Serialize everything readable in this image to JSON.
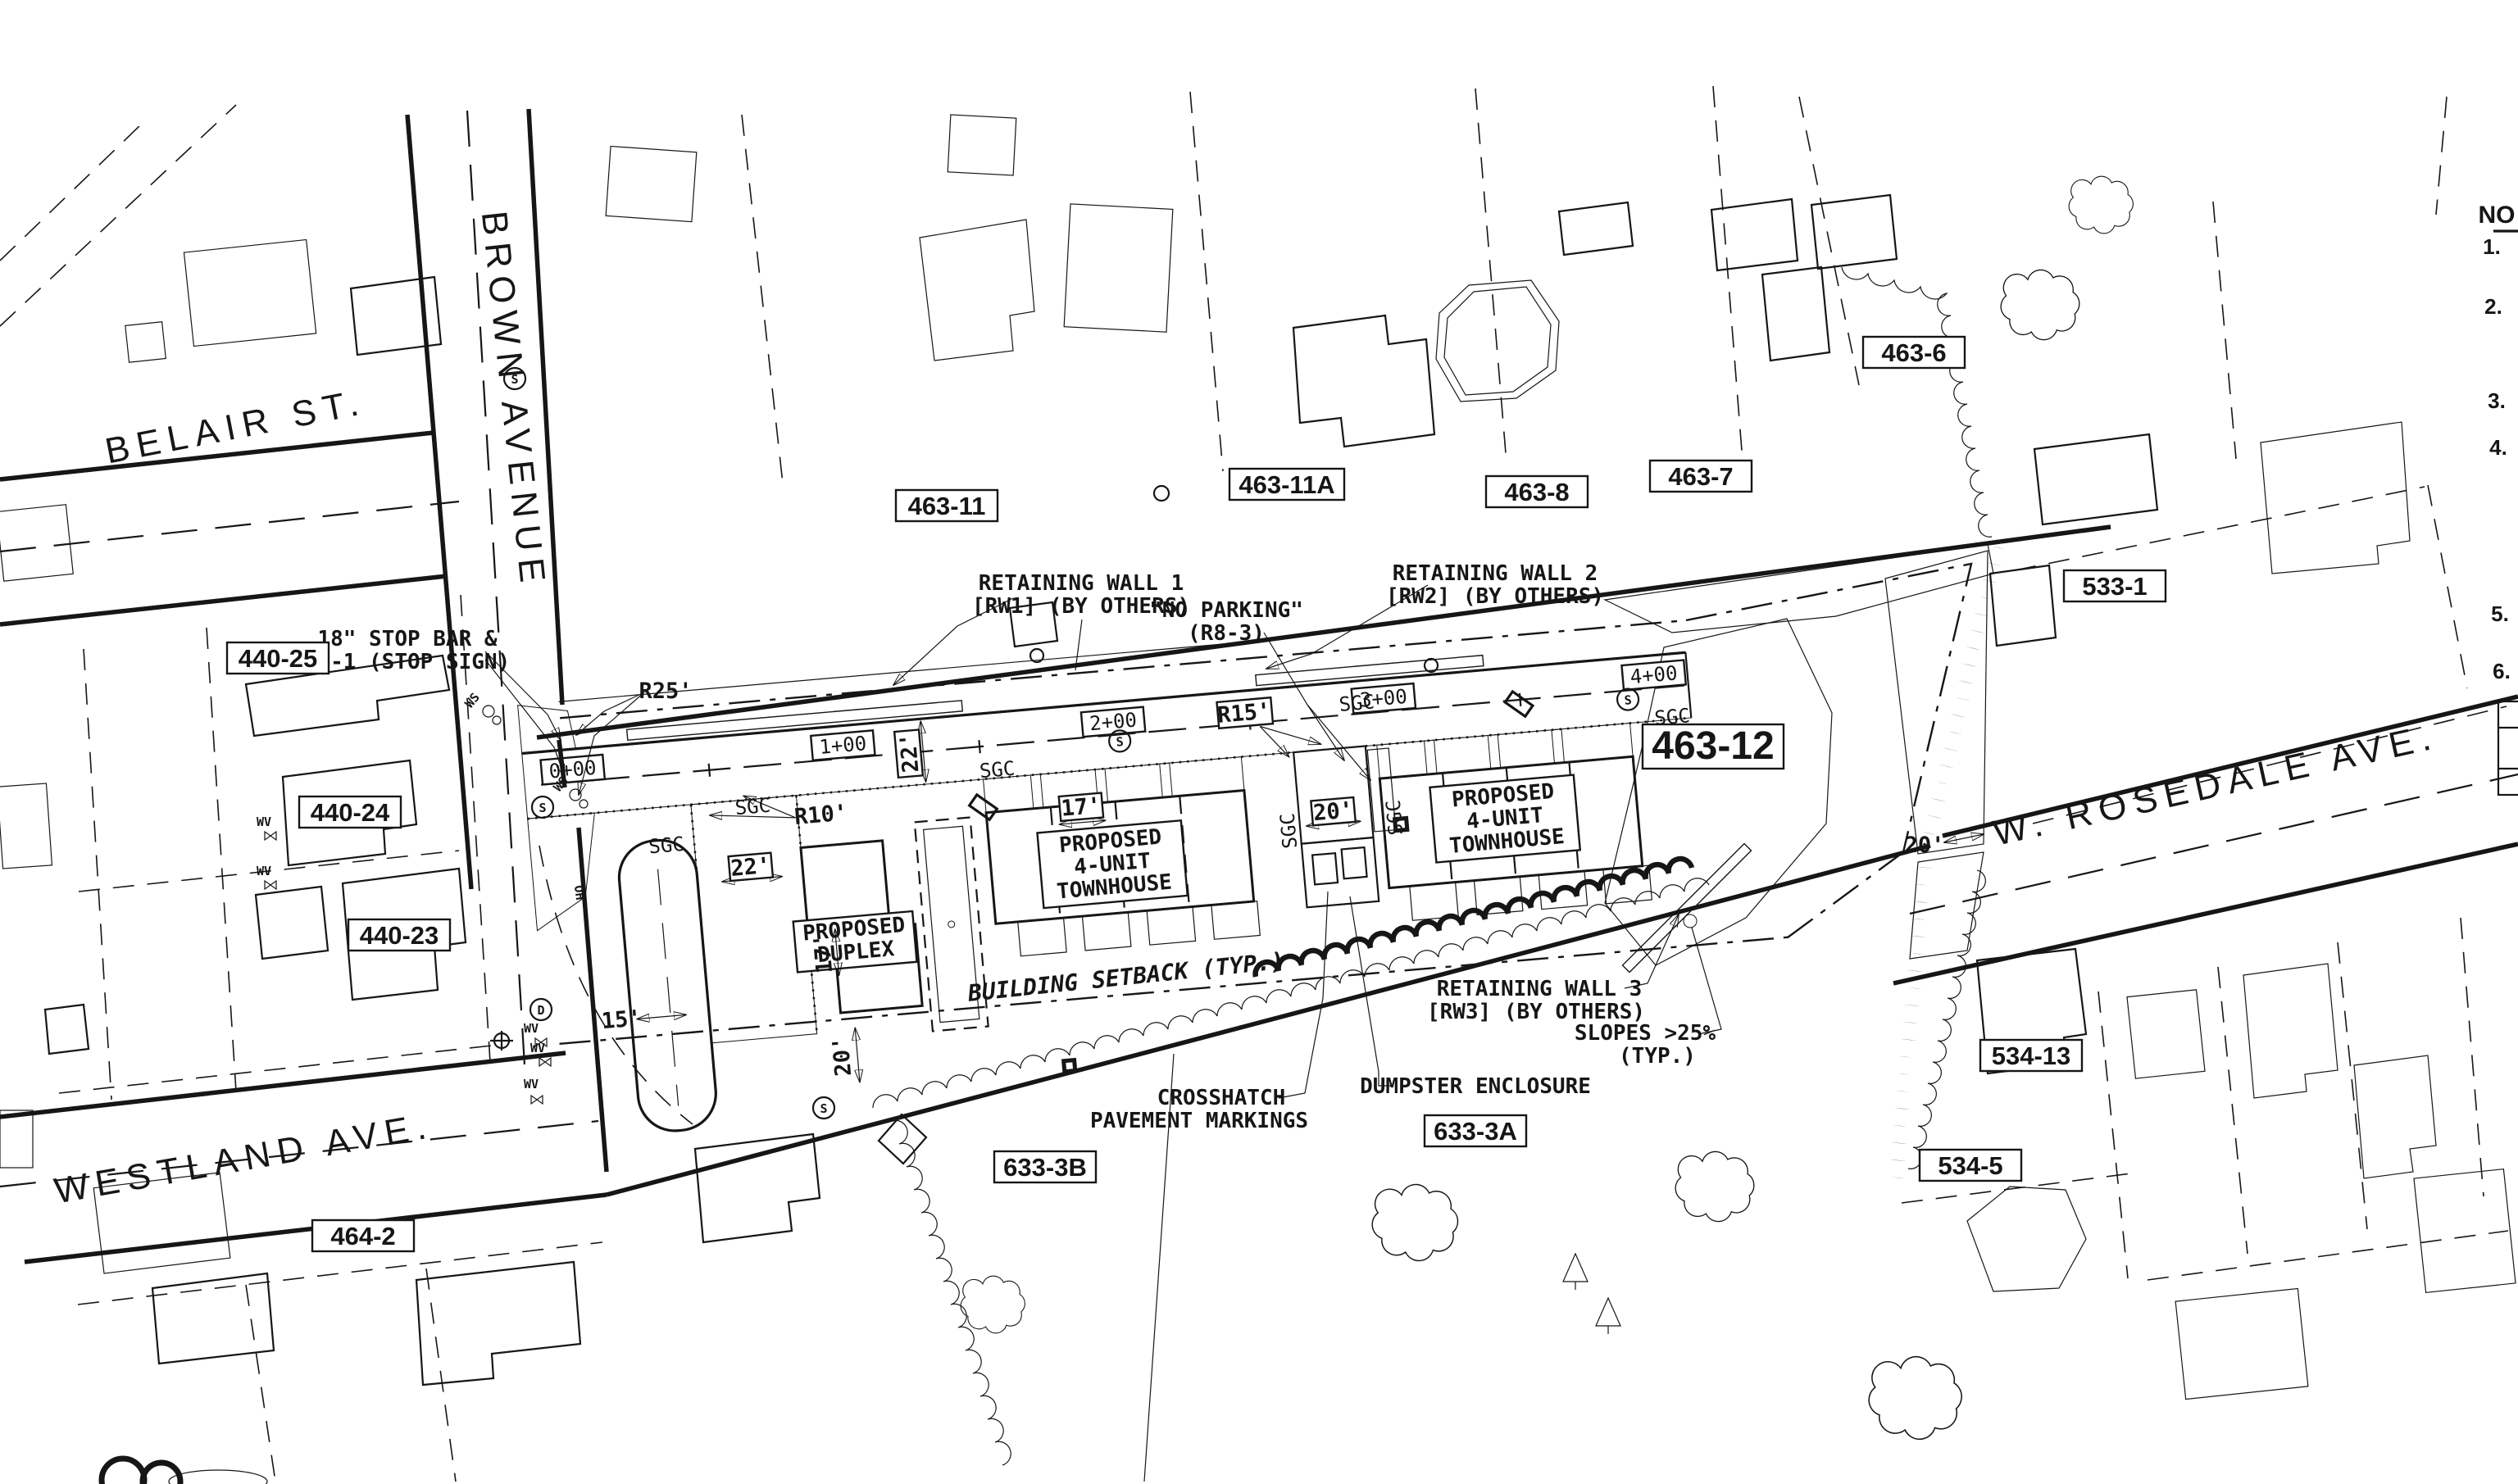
{
  "plan": {
    "streets": {
      "belair": "BELAIR ST.",
      "brown": "BROWN AVENUE",
      "westland": "WESTLAND AVE.",
      "rosedale": "W. ROSEDALE AVE."
    },
    "parcels": {
      "p440_25": "440-25",
      "p440_24": "440-24",
      "p440_23": "440-23",
      "p464_2": "464-2",
      "p463_11": "463-11",
      "p463_11a": "463-11A",
      "p463_8": "463-8",
      "p463_7": "463-7",
      "p463_6": "463-6",
      "p533_1": "533-1",
      "p463_12": "463-12",
      "p534_13": "534-13",
      "p534_5": "534-5",
      "p633_3b": "633-3B",
      "p633_3a": "633-3A"
    },
    "stations": [
      "0+00",
      "1+00",
      "2+00",
      "3+00",
      "4+00"
    ],
    "proposed": {
      "duplex_l1": "PROPOSED",
      "duplex_l2": "DUPLEX",
      "th_l1": "PROPOSED",
      "th_l2": "4-UNIT",
      "th_l3": "TOWNHOUSE"
    },
    "annotations": {
      "stop_bar_l1": "18\" STOP BAR &",
      "stop_bar_l2": "R1-1 (STOP SIGN)",
      "rw1_l1": "RETAINING WALL 1",
      "rw1_l2": "[RW1] (BY OTHERS)",
      "no_parking_l1": "\"NO PARKING\"",
      "no_parking_l2": "(R8-3)",
      "rw2_l1": "RETAINING WALL 2",
      "rw2_l2": "[RW2] (BY OTHERS)",
      "rw3_l1": "RETAINING WALL 3",
      "rw3_l2": "[RW3] (BY OTHERS)",
      "slopes_l1": "SLOPES >25%",
      "slopes_l2": "(TYP.)",
      "crosshatch_l1": "CROSSHATCH",
      "crosshatch_l2": "PAVEMENT MARKINGS",
      "dumpster": "DUMPSTER ENCLOSURE",
      "setback": "BUILDING SETBACK (TYP.)"
    },
    "dims": {
      "r25": "R25'",
      "r15": "R15'",
      "r10": "R10'",
      "d22": "22'",
      "d17": "17'",
      "d20": "20'",
      "d15": "15'"
    },
    "symbols": {
      "sgc": "SGC",
      "s": "S",
      "d": "D",
      "wv": "WV",
      "ws": "WS",
      "oh": "OH"
    },
    "notes": {
      "heading": "NO",
      "items": [
        "1.",
        "2.",
        "3.",
        "4.",
        "5.",
        "6."
      ]
    },
    "colors": {
      "road": "#b5b5b5",
      "wall": "#676767",
      "building": "#a58b4e",
      "ink": "#161616"
    }
  }
}
